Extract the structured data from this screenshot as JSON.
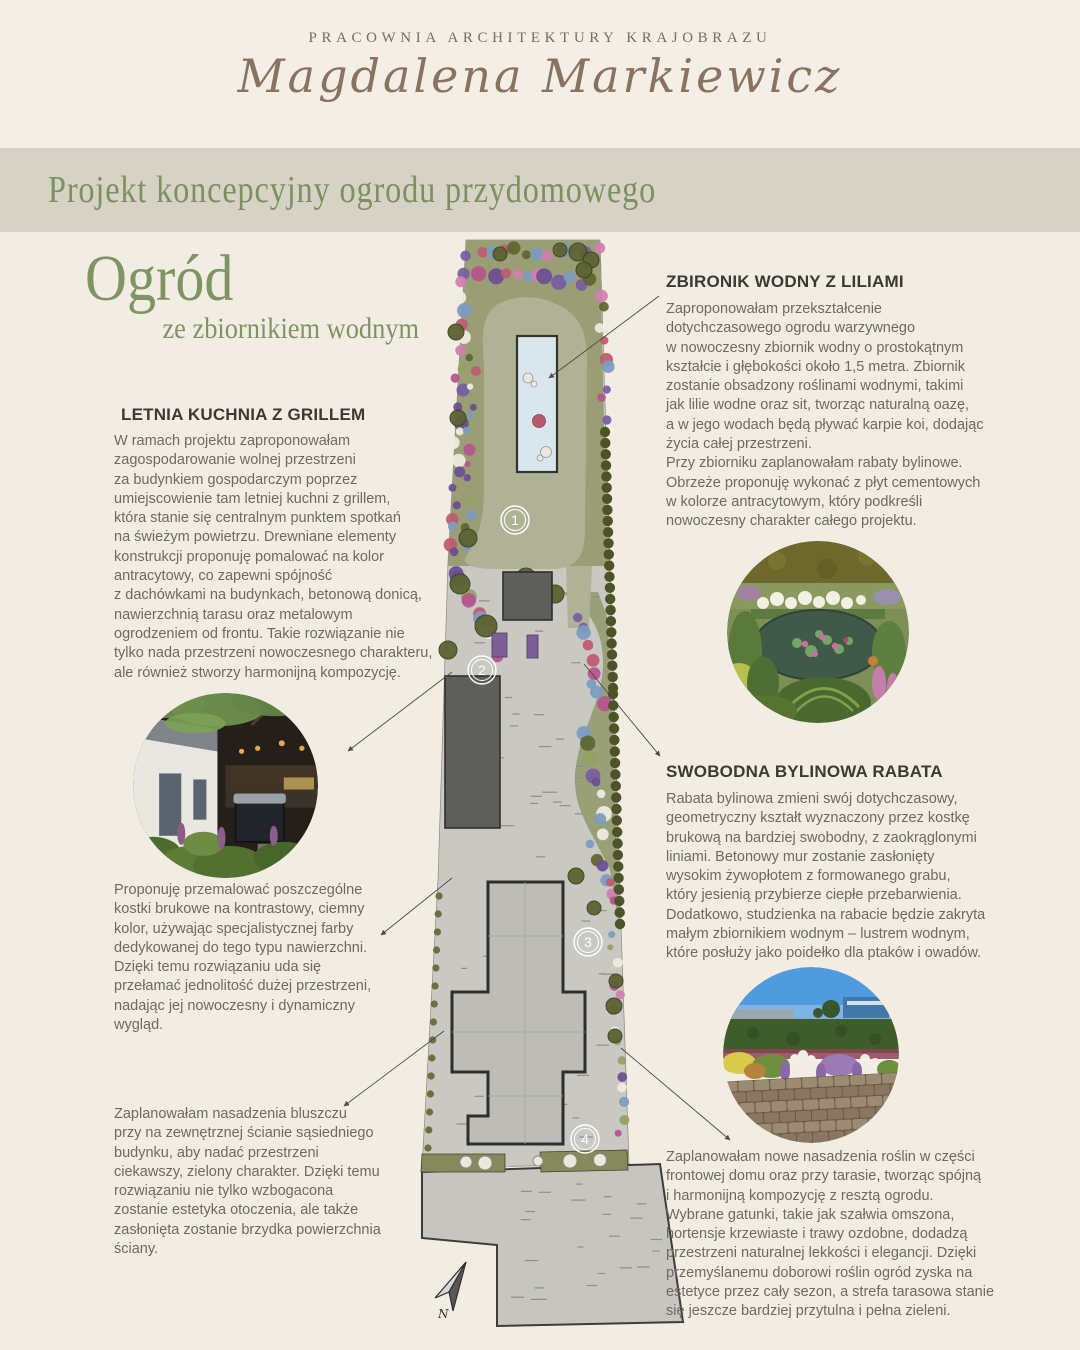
{
  "header": {
    "studio": "PRACOWNIA ARCHITEKTURY KRAJOBRAZU",
    "name": "Magdalena Markiewicz"
  },
  "banner": {
    "title": "Projekt koncepcyjny ogrodu przydomowego"
  },
  "title": {
    "main": "Ogród",
    "sub": "ze zbiornikiem wodnym"
  },
  "sections": {
    "letnia": {
      "heading": "LETNIA KUCHNIA Z GRILLEM",
      "body": "W ramach projektu zaproponowałam\nzagospodarowanie wolnej przestrzeni\nza budynkiem gospodarczym poprzez\numiejscowienie tam letniej kuchni z grillem,\nktóra stanie się centralnym punktem spotkań\nna świeżym powietrzu. Drewniane elementy\nkonstrukcji proponuję pomalować na kolor\nantracytowy, co zapewni spójność\nz dachówkami na budynkach, betonową donicą,\nnawierzchnią tarasu oraz metalowym\nogrodzeniem od frontu. Takie rozwiązanie nie\ntylko nada przestrzeni nowoczesnego charakteru,\nale również stworzy harmonijną kompozycję."
    },
    "kostki": {
      "body": "Proponuję przemalować poszczególne\nkostki brukowe na kontrastowy, ciemny\nkolor, używając specjalistycznej farby\ndedykowanej do tego typu nawierzchni.\nDzięki temu rozwiązaniu uda się\nprzełamać jednolitość dużej przestrzeni,\nnadając jej nowoczesny i dynamiczny\nwygląd."
    },
    "bluszcz": {
      "body": "Zaplanowałam  nasadzenia bluszczu\nprzy na zewnętrznej ścianie sąsiedniego\nbudynku, aby nadać przestrzeni\nciekawszy, zielony charakter. Dzięki temu\nrozwiązaniu nie tylko wzbogacona\nzostanie estetyka otoczenia, ale także\nzasłonięta zostanie brzydka powierzchnia\nściany."
    },
    "zbiornik": {
      "heading": "ZBIRONIK WODNY Z LILIAMI",
      "body": "Zaproponowałam przekształcenie\ndotychczasowego ogrodu warzywnego\nw nowoczesny zbiornik wodny o prostokątnym\nkształcie i głębokości około 1,5 metra. Zbiornik\nzostanie obsadzony roślinami wodnymi, takimi\njak lilie wodne oraz sit, tworząc naturalną oazę,\na w jego wodach będą pływać karpie koi, dodając\nżycia całej przestrzeni.\nPrzy zbiorniku zaplanowałam rabaty bylinowe.\nObrzeże proponuję wykonać z płyt cementowych\nw kolorze antracytowym, który podkreśli\nnowoczesny charakter całego projektu."
    },
    "rabata": {
      "heading": "SWOBODNA BYLINOWA RABATA",
      "body": "Rabata bylinowa zmieni swój dotychczasowy,\ngeometryczny kształt wyznaczony przez kostkę\nbrukową na bardziej swobodny, z zaokrąglonymi\nliniami. Betonowy mur zostanie zasłonięty\nwysokim żywopłotem z formowanego grabu,\nktóry jesienią przybierze ciepłe przebarwienia.\nDodatkowo, studzienka na rabacie będzie zakryta\nmałym zbiornikiem wodnym – lustrem wodnym,\nktóre posłuży jako poidełko dla ptaków i owadów."
    },
    "front": {
      "body": "Zaplanowałam nowe nasadzenia roślin w części\nfrontowej domu oraz przy tarasie, tworząc spójną\ni harmonijną kompozycję z resztą ogrodu.\nWybrane gatunki, takie jak szałwia omszona,\nhortensje krzewiaste i trawy ozdobne, dodadzą\nprzestrzeni naturalnej lekkości i elegancji. Dzięki\nprzemyślanemu doborowi roślin ogród zyska na\nestetyce przez cały sezon, a strefa tarasowa stanie\nsię jeszcze bardziej przytulna i pełna zieleni."
    }
  },
  "plan": {
    "markers": [
      "1",
      "2",
      "3",
      "4"
    ],
    "north_label": "N"
  },
  "colors": {
    "page_bg": "#f2ede3",
    "banner_bg": "#d6d2c6",
    "accent_green": "#7c9161",
    "heading_brown": "#7f6b57",
    "body_text": "#6e6a62",
    "lawn": "#b0b295",
    "pond": "#d9e6ee"
  }
}
